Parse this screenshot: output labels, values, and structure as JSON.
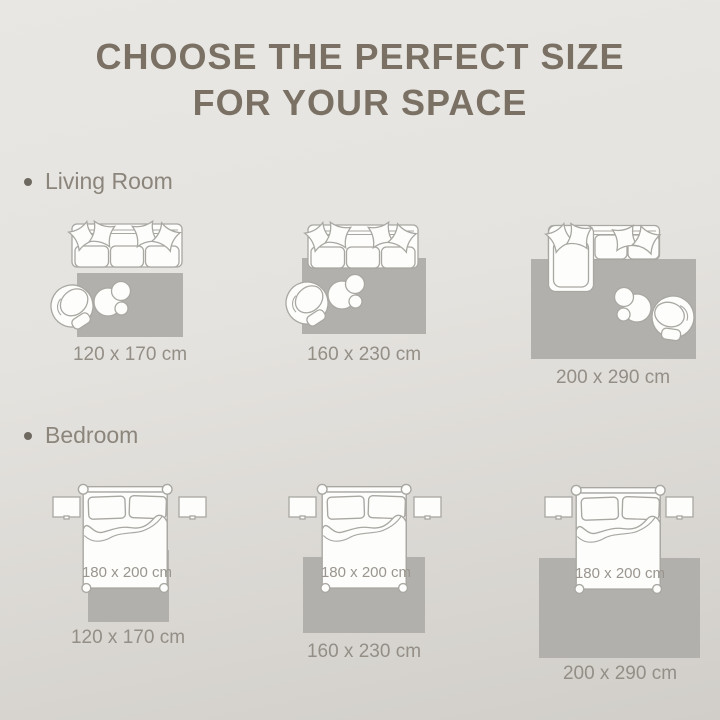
{
  "title": {
    "line1": "CHOOSE THE PERFECT SIZE",
    "line2": "FOR YOUR SPACE"
  },
  "sections": {
    "living_room": {
      "label": "Living Room",
      "options": [
        {
          "rug_size": "120 x 170 cm"
        },
        {
          "rug_size": "160 x 230 cm"
        },
        {
          "rug_size": "200 x 290 cm"
        }
      ]
    },
    "bedroom": {
      "label": "Bedroom",
      "options": [
        {
          "rug_size": "120 x 170 cm",
          "bed_size": "180 x 200 cm"
        },
        {
          "rug_size": "160 x 230 cm",
          "bed_size": "180 x 200 cm"
        },
        {
          "rug_size": "200 x 290 cm",
          "bed_size": "180 x 200 cm"
        }
      ]
    }
  },
  "icons": {
    "living_room_items": [
      "three-seat-sofa-top-view",
      "armchair-top-view",
      "round-nesting-tables",
      "rug"
    ],
    "bedroom_items": [
      "double-bed-top-view",
      "nightstand",
      "rug"
    ]
  },
  "colors": {
    "background_top": "#e9e7e3",
    "background_bottom": "#d1cec9",
    "title_text": "#7a7164",
    "section_text": "#8b857c",
    "caption_text": "#938e86",
    "bed_label_text": "#9a958e",
    "rug_fill": "#b1b0ac",
    "furniture_outline": "#a9a7a2",
    "furniture_fill": "#fdfdfb"
  }
}
